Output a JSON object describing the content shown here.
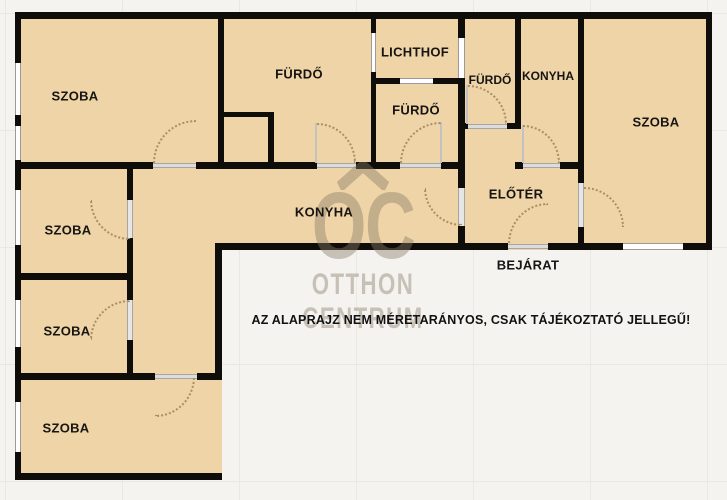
{
  "floor_plan": {
    "rooms": [
      {
        "id": "szoba-top-left",
        "label": "SZOBA"
      },
      {
        "id": "furdo-large",
        "label": "FÜRDŐ"
      },
      {
        "id": "lichthof",
        "label": "LICHTHOF"
      },
      {
        "id": "furdo-middle",
        "label": "FÜRDŐ"
      },
      {
        "id": "furdo-small",
        "label": "FÜRDŐ"
      },
      {
        "id": "konyha-top",
        "label": "KONYHA"
      },
      {
        "id": "szoba-right",
        "label": "SZOBA"
      },
      {
        "id": "konyha-main",
        "label": "KONYHA"
      },
      {
        "id": "eloter",
        "label": "ELŐTÉR"
      },
      {
        "id": "szoba-left-2",
        "label": "SZOBA"
      },
      {
        "id": "szoba-left-3",
        "label": "SZOBA"
      },
      {
        "id": "szoba-bottom",
        "label": "SZOBA"
      }
    ],
    "entrance_label": "BEJÁRAT",
    "disclaimer": "AZ ALAPRAJZ NEM MÉRETARÁNYOS, CSAK TÁJÉKOZTATÓ JELLEGŰ!",
    "watermark": {
      "logo_text": "OC",
      "brand_line1": "OTTHON",
      "brand_line2": "CENTRUM"
    },
    "colors": {
      "room_fill": "#eed4a6",
      "wall": "#0f0d0a",
      "watermark": "#8a7c68",
      "background": "#f4f3ef"
    }
  }
}
